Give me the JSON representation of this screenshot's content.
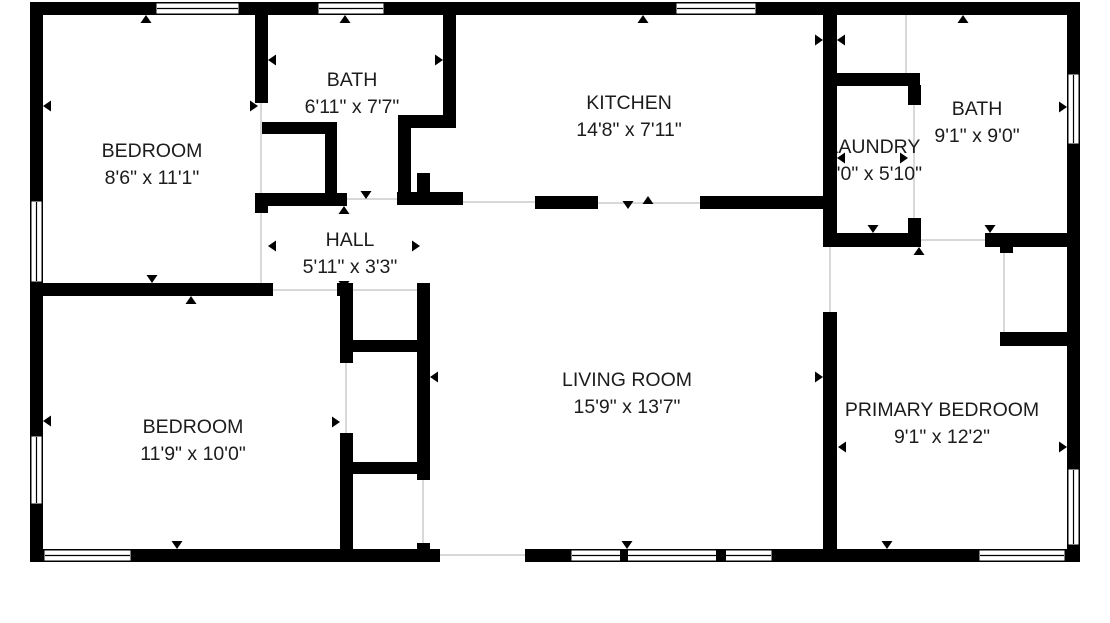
{
  "canvas": {
    "width": 1110,
    "height": 623,
    "background": "#ffffff",
    "wall_color": "#000000",
    "text_color": "#1c1c1c",
    "opening_line_color": "#cccccc",
    "label_font_size": 19.5,
    "label_line_gap": 27
  },
  "rooms": [
    {
      "id": "bedroom-top-left",
      "name": "BEDROOM",
      "dims": "8'6\" x 11'1\"",
      "cx": 152,
      "cy": 152
    },
    {
      "id": "bath-top",
      "name": "BATH",
      "dims": "6'11\" x 7'7\"",
      "cx": 352,
      "cy": 81
    },
    {
      "id": "kitchen",
      "name": "KITCHEN",
      "dims": "14'8\" x 7'11\"",
      "cx": 629,
      "cy": 104
    },
    {
      "id": "laundry",
      "name": "LAUNDRY",
      "dims": "5'0\" x 5'10\"",
      "cx": 874,
      "cy": 148
    },
    {
      "id": "bath-right",
      "name": "BATH",
      "dims": "9'1\" x 9'0\"",
      "cx": 977,
      "cy": 110
    },
    {
      "id": "hall",
      "name": "HALL",
      "dims": "5'11\" x 3'3\"",
      "cx": 350,
      "cy": 241
    },
    {
      "id": "living-room",
      "name": "LIVING ROOM",
      "dims": "15'9\" x 13'7\"",
      "cx": 627,
      "cy": 381
    },
    {
      "id": "bedroom-bottom-left",
      "name": "BEDROOM",
      "dims": "11'9\" x 10'0\"",
      "cx": 193,
      "cy": 428
    },
    {
      "id": "primary-bedroom",
      "name": "PRIMARY BEDROOM",
      "dims": "9'1\" x 12'2\"",
      "cx": 942,
      "cy": 411
    }
  ],
  "walls": [
    [
      30,
      2,
      1050,
      13
    ],
    [
      30,
      2,
      13,
      560
    ],
    [
      1067,
      2,
      13,
      560
    ],
    [
      30,
      549,
      410,
      13
    ],
    [
      525,
      549,
      555,
      13
    ],
    [
      255,
      15,
      13,
      88
    ],
    [
      262,
      122,
      75,
      12
    ],
    [
      325,
      122,
      12,
      84
    ],
    [
      255,
      193,
      13,
      20
    ],
    [
      30,
      283,
      243,
      13
    ],
    [
      337,
      283,
      16,
      13
    ],
    [
      258,
      193,
      89,
      13
    ],
    [
      397,
      192,
      66,
      13
    ],
    [
      535,
      196,
      63,
      13
    ],
    [
      700,
      196,
      130,
      13
    ],
    [
      443,
      15,
      13,
      113
    ],
    [
      398,
      115,
      58,
      13
    ],
    [
      398,
      115,
      13,
      90
    ],
    [
      417,
      173,
      13,
      32
    ],
    [
      340,
      283,
      13,
      80
    ],
    [
      340,
      433,
      13,
      120
    ],
    [
      417,
      283,
      13,
      197
    ],
    [
      417,
      543,
      13,
      10
    ],
    [
      340,
      340,
      90,
      12
    ],
    [
      340,
      462,
      90,
      12
    ],
    [
      823,
      15,
      14,
      227
    ],
    [
      823,
      73,
      97,
      13
    ],
    [
      908,
      85,
      13,
      20
    ],
    [
      908,
      218,
      13,
      29
    ],
    [
      823,
      233,
      97,
      14
    ],
    [
      985,
      233,
      82,
      14
    ],
    [
      1000,
      243,
      13,
      10
    ],
    [
      1000,
      332,
      67,
      14
    ],
    [
      823,
      312,
      14,
      240
    ]
  ],
  "windows": [
    {
      "x": 155,
      "y": 2,
      "w": 85,
      "h": 13,
      "orient": "h"
    },
    {
      "x": 317,
      "y": 2,
      "w": 68,
      "h": 13,
      "orient": "h"
    },
    {
      "x": 675,
      "y": 2,
      "w": 82,
      "h": 13,
      "orient": "h"
    },
    {
      "x": 30,
      "y": 200,
      "w": 13,
      "h": 83,
      "orient": "v"
    },
    {
      "x": 30,
      "y": 435,
      "w": 13,
      "h": 70,
      "orient": "v"
    },
    {
      "x": 1067,
      "y": 73,
      "w": 13,
      "h": 72,
      "orient": "v"
    },
    {
      "x": 1067,
      "y": 468,
      "w": 13,
      "h": 78,
      "orient": "v"
    },
    {
      "x": 43,
      "y": 549,
      "w": 89,
      "h": 13,
      "orient": "h"
    },
    {
      "x": 570,
      "y": 549,
      "w": 203,
      "h": 13,
      "orient": "h"
    },
    {
      "x": 978,
      "y": 549,
      "w": 88,
      "h": 13,
      "orient": "h"
    }
  ],
  "window_mullions": [
    [
      620,
      549,
      8,
      13
    ],
    [
      716,
      549,
      10,
      13
    ]
  ],
  "opening_lines": [
    [
      261,
      103,
      261,
      283
    ],
    [
      347,
      199,
      397,
      199
    ],
    [
      273,
      290,
      337,
      290
    ],
    [
      353,
      290,
      417,
      290
    ],
    [
      346,
      363,
      346,
      433
    ],
    [
      423,
      480,
      423,
      543
    ],
    [
      463,
      202,
      535,
      202
    ],
    [
      598,
      203,
      700,
      203
    ],
    [
      440,
      555,
      525,
      555
    ],
    [
      914,
      105,
      914,
      218
    ],
    [
      906,
      15,
      906,
      73
    ],
    [
      920,
      240,
      985,
      240
    ],
    [
      1004,
      253,
      1004,
      332
    ],
    [
      830,
      242,
      830,
      312
    ]
  ],
  "door_arrows": [
    {
      "x": 146,
      "y": 15,
      "dir": "up"
    },
    {
      "x": 345,
      "y": 15,
      "dir": "up"
    },
    {
      "x": 643,
      "y": 15,
      "dir": "up"
    },
    {
      "x": 963,
      "y": 15,
      "dir": "up"
    },
    {
      "x": 43,
      "y": 106,
      "dir": "left"
    },
    {
      "x": 258,
      "y": 106,
      "dir": "right"
    },
    {
      "x": 268,
      "y": 60,
      "dir": "left"
    },
    {
      "x": 443,
      "y": 60,
      "dir": "right"
    },
    {
      "x": 366,
      "y": 199,
      "dir": "down"
    },
    {
      "x": 344,
      "y": 206,
      "dir": "up"
    },
    {
      "x": 268,
      "y": 246,
      "dir": "left"
    },
    {
      "x": 420,
      "y": 246,
      "dir": "right"
    },
    {
      "x": 344,
      "y": 289,
      "dir": "down"
    },
    {
      "x": 152,
      "y": 283,
      "dir": "down"
    },
    {
      "x": 191,
      "y": 296,
      "dir": "up"
    },
    {
      "x": 340,
      "y": 422,
      "dir": "right"
    },
    {
      "x": 430,
      "y": 377,
      "dir": "left"
    },
    {
      "x": 628,
      "y": 209,
      "dir": "down"
    },
    {
      "x": 648,
      "y": 196,
      "dir": "up"
    },
    {
      "x": 627,
      "y": 549,
      "dir": "down"
    },
    {
      "x": 177,
      "y": 549,
      "dir": "down"
    },
    {
      "x": 887,
      "y": 549,
      "dir": "down"
    },
    {
      "x": 823,
      "y": 40,
      "dir": "right"
    },
    {
      "x": 837,
      "y": 40,
      "dir": "left"
    },
    {
      "x": 837,
      "y": 158,
      "dir": "left"
    },
    {
      "x": 908,
      "y": 158,
      "dir": "right"
    },
    {
      "x": 873,
      "y": 233,
      "dir": "down"
    },
    {
      "x": 919,
      "y": 247,
      "dir": "up"
    },
    {
      "x": 990,
      "y": 233,
      "dir": "down"
    },
    {
      "x": 1067,
      "y": 107,
      "dir": "right"
    },
    {
      "x": 823,
      "y": 377,
      "dir": "right"
    },
    {
      "x": 838,
      "y": 447,
      "dir": "left"
    },
    {
      "x": 1067,
      "y": 447,
      "dir": "right"
    },
    {
      "x": 43,
      "y": 421,
      "dir": "left"
    }
  ]
}
